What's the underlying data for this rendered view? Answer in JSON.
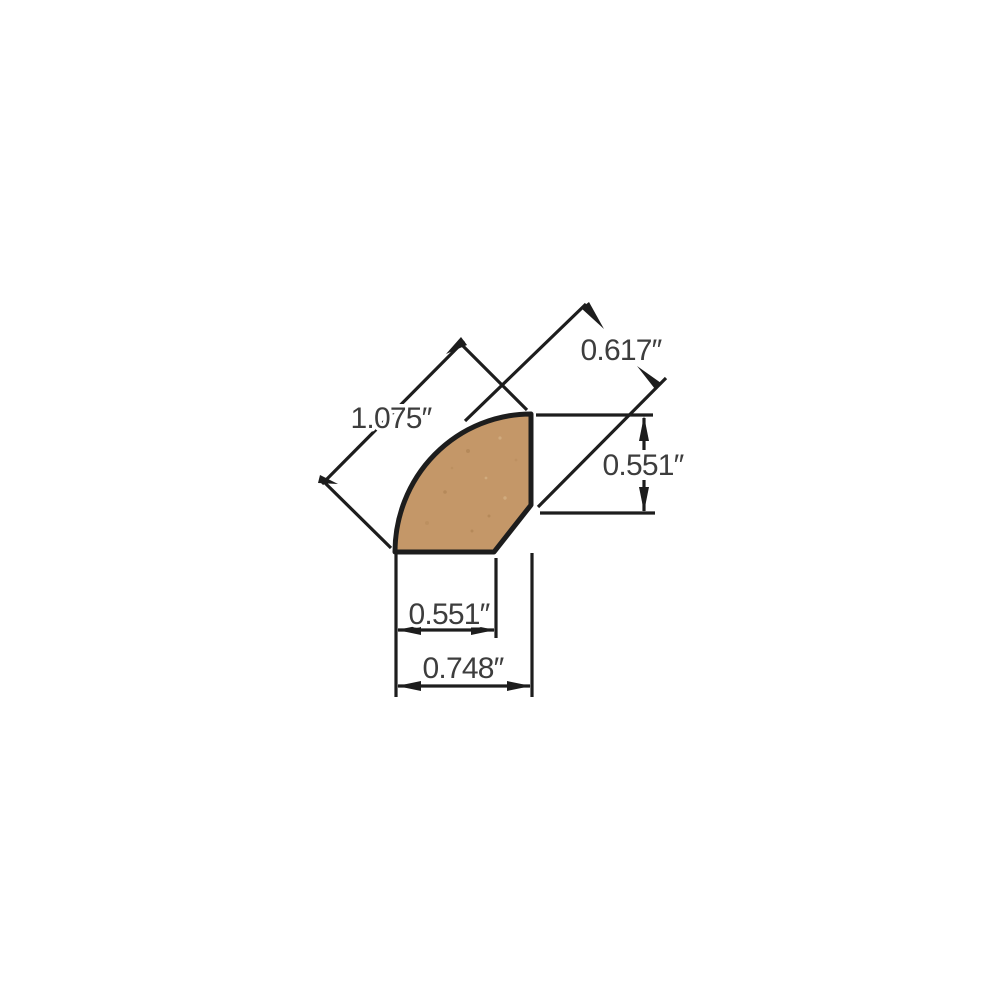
{
  "drawing": {
    "type": "technical dimension drawing",
    "subject": "quarter round moulding profile cross-section",
    "background_color": "#ffffff",
    "colors": {
      "wood_fill": "#c49768",
      "line": "#1d1d1d",
      "label_text": "#3d3d3d"
    },
    "dimensions": [
      {
        "id": "diagonal-overall",
        "value": "1.075″"
      },
      {
        "id": "top-face-diagonal",
        "value": "0.617″"
      },
      {
        "id": "right-height",
        "value": "0.551″"
      },
      {
        "id": "bottom-inner-width",
        "value": "0.551″"
      },
      {
        "id": "bottom-overall-width",
        "value": "0.748″"
      }
    ]
  }
}
